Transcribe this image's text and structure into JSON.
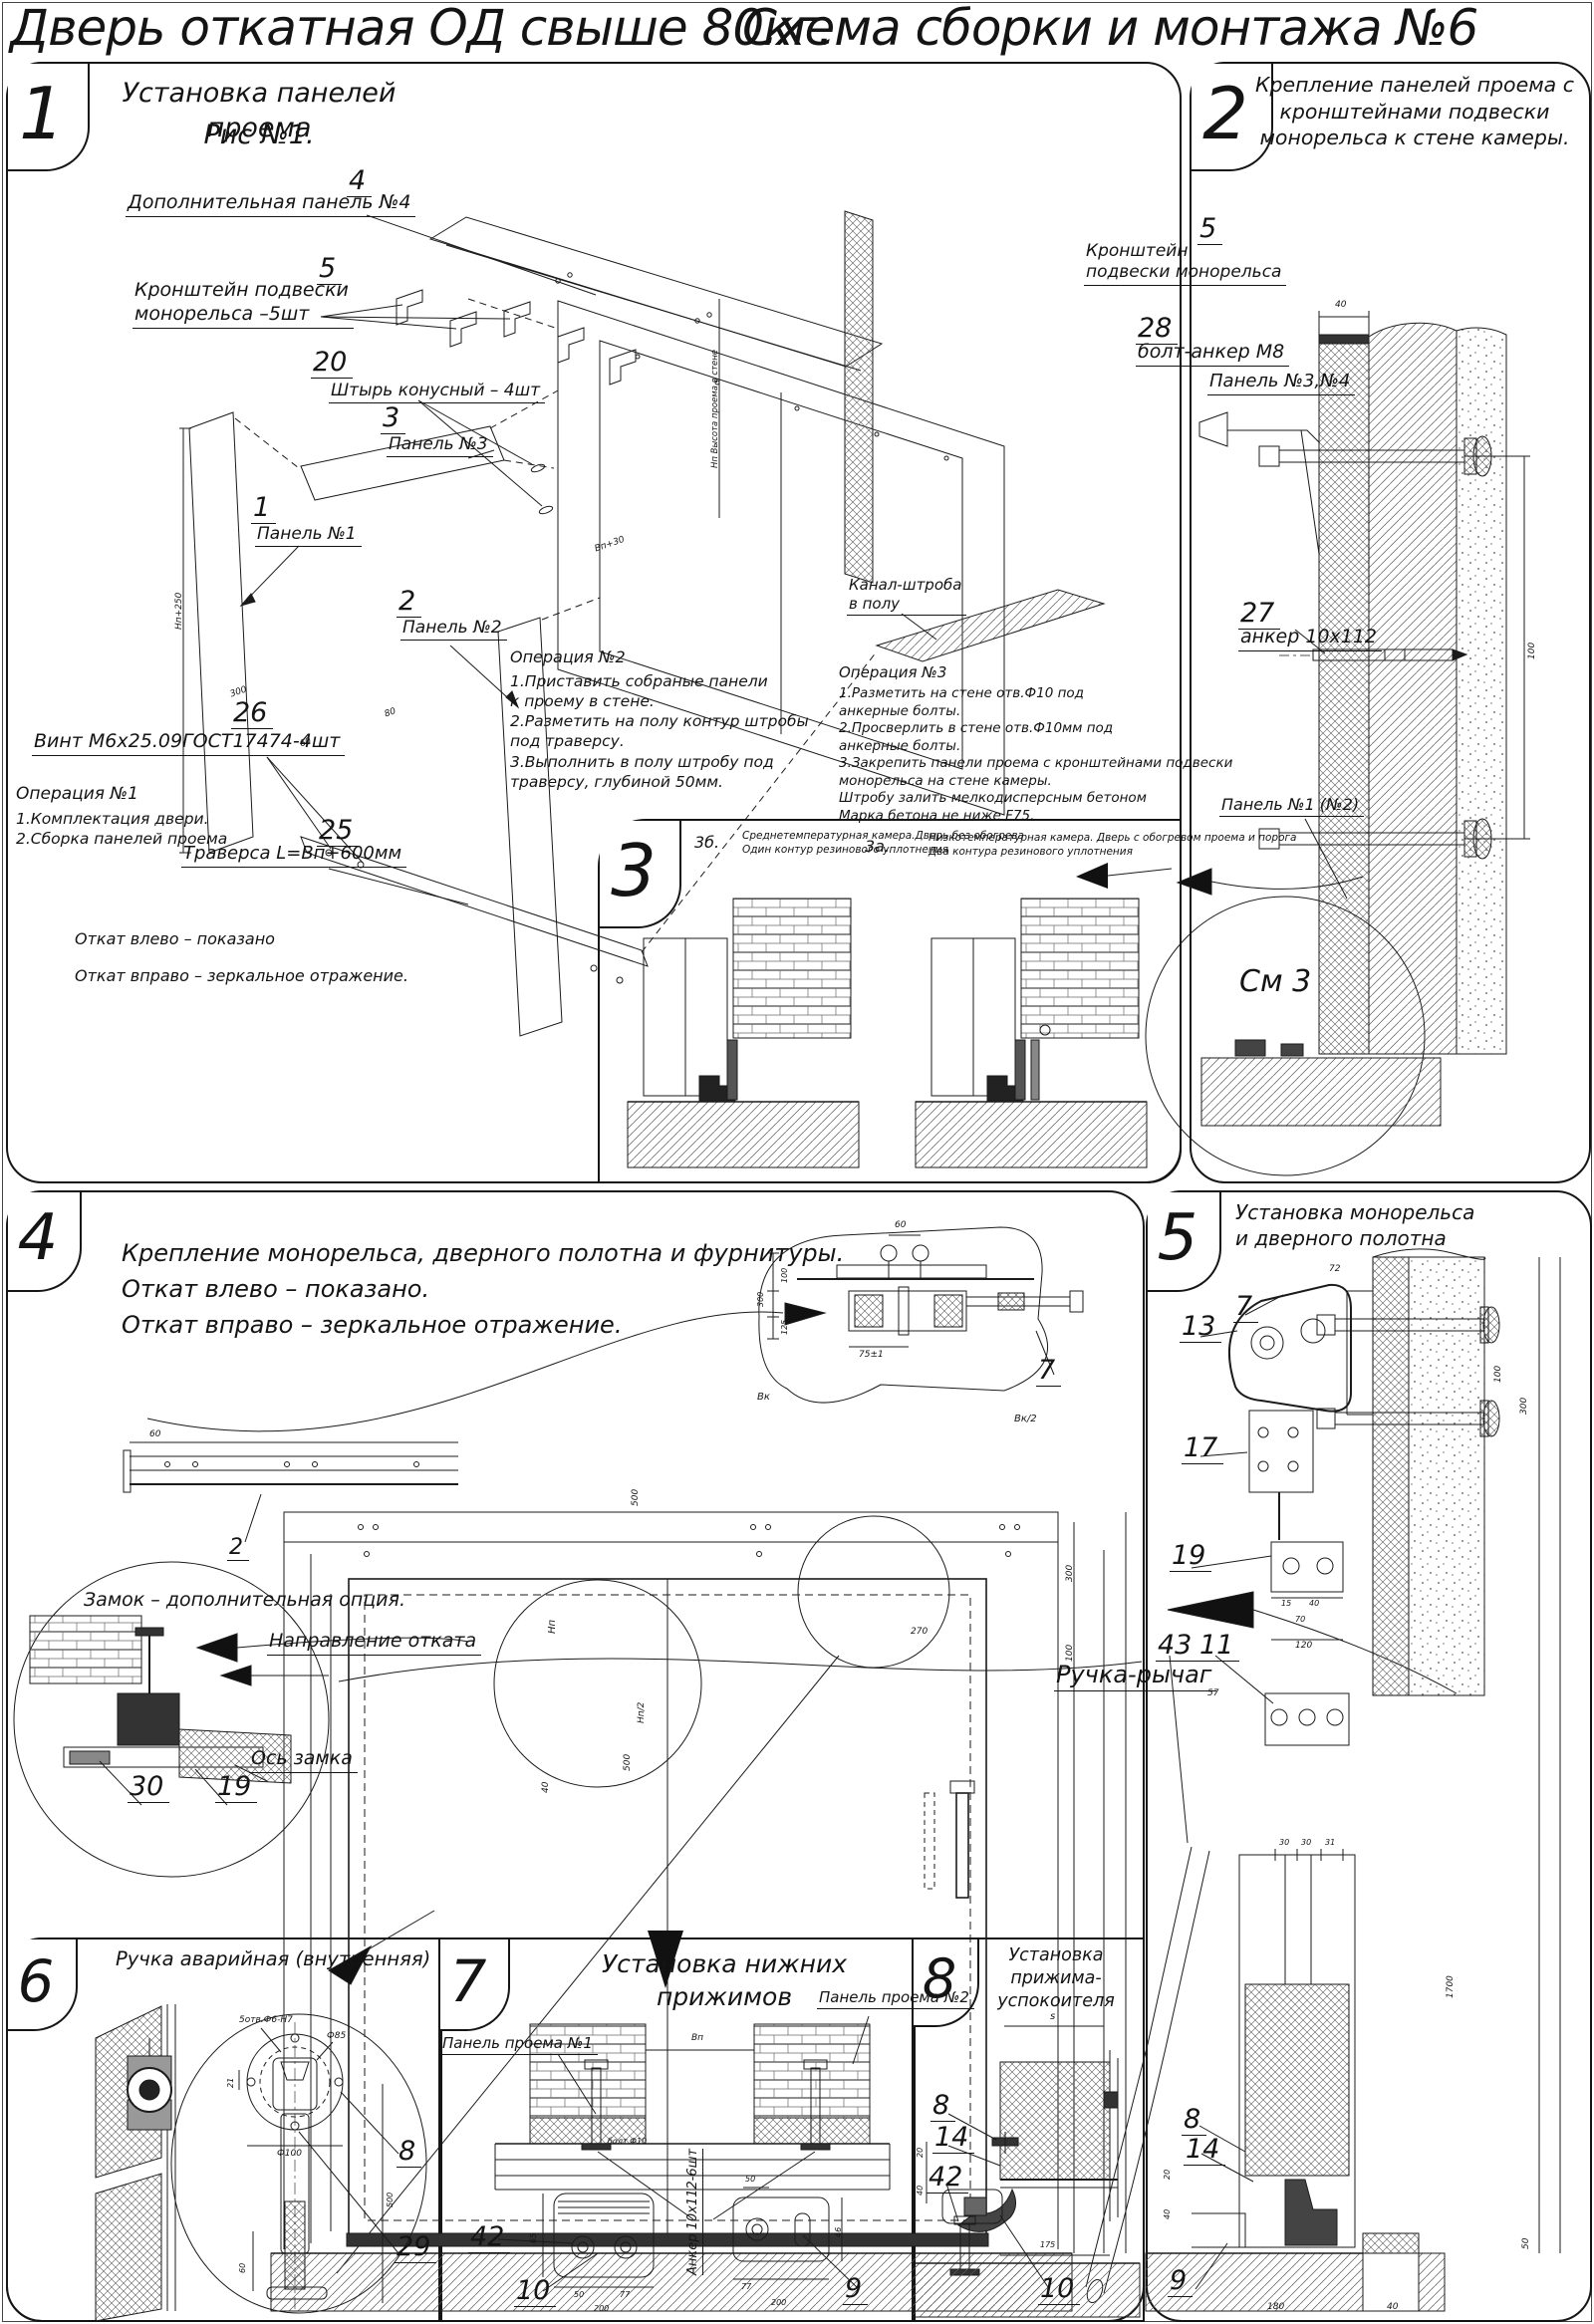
{
  "page": {
    "title_left": "Дверь откатная ОД свыше 80кг.",
    "title_right": "Схема сборки и монтажа №6"
  },
  "s1": {
    "num": "1",
    "title": "Установка панелей проема",
    "subtitle": "Рис №1.",
    "callouts": {
      "c4": {
        "num": "4",
        "label": "Дополнительная панель №4"
      },
      "c5": {
        "num": "5",
        "label": "Кронштейн подвески\nмонорельса –5шт"
      },
      "c20": {
        "num": "20",
        "label": "Штырь конусный – 4шт"
      },
      "c3": {
        "num": "3",
        "label": "Панель №3"
      },
      "c1": {
        "num": "1",
        "label": "Панель №1"
      },
      "c2": {
        "num": "2",
        "label": "Панель №2"
      },
      "c26": {
        "num": "26",
        "label": "Винт М6х25.09ГОСТ17474-4шт"
      },
      "c25": {
        "num": "25",
        "label": "Траверса  L=Вп+600мм"
      },
      "kanal": {
        "label": "Канал-штроба\nв полу"
      }
    },
    "op1_title": "Операция №1",
    "op1_text": "1.Комплектация двери.\n2.Сборка панелей проема",
    "op2_title": "Операция №2",
    "op2_text": "1.Приставить собраные панели\nк проему в стене.\n2.Разметить на полу контур штробы\nпод траверсу.\n3.Выполнить в полу штробу под\nтраверсу, глубиной 50мм.",
    "op3_title": "Операция №3",
    "op3_text": "1.Разметить на стене отв.Ф10 под\nанкерные болты.\n2.Просверлить в стене отв.Ф10мм   под\nанкерные болты.\n3.Закрепить панели проема с кронштейнами подвески\nмонорельса на стене камеры.\nШтробу залить мелкодисперсным бетоном\nМарка бетона не ниже   F75.",
    "note1": "Откат влево – показано",
    "note2": "Откат вправо – зеркальное отражение.",
    "dims": {
      "hp": "Нп+250",
      "bp30": "Вп+30",
      "d300": "300",
      "d80": "80",
      "d60": "60",
      "hp_note": "Нп Высота проема в стене"
    }
  },
  "s2": {
    "num": "2",
    "title": "Крепление панелей проема с\nкронштейнами  подвески\nмонорельса к стене камеры.",
    "callouts": {
      "c5": {
        "num": "5",
        "label": "Кронштейн\nподвески монорельса"
      },
      "c28": {
        "num": "28",
        "label": "болт-анкер М8"
      },
      "p34": {
        "label": "Панель №3,№4"
      },
      "c27": {
        "num": "27",
        "label": "анкер 10х112"
      },
      "p12": {
        "label": "Панель №1 (№2)"
      },
      "sm3": {
        "label": "См 3"
      }
    },
    "dims": {
      "d40": "40",
      "d100": "100"
    }
  },
  "s3": {
    "num": "3",
    "b_key": "3б.",
    "b_text": "Среднетемпературная камера.Дверь без обогрева\nОдин контур резинового уплотнения",
    "a_key": "3а.",
    "a_text": "Низкотемпературная камера. Дверь с обогревом проема и порога\nДва контура резинового уплотнения"
  },
  "s4": {
    "num": "4",
    "title": "Крепление монорельса, дверного полотна и фурнитуры.\nОткат влево – показано.\nОткат вправо – зеркальное отражение.",
    "callouts": {
      "c7": {
        "num": "7"
      },
      "c2": {
        "num": "2"
      },
      "c30": {
        "num": "30"
      },
      "c19": {
        "num": "19"
      },
      "zamok": {
        "label": "Замок – дополнительная опция."
      },
      "napr": {
        "label": "Направление отката"
      },
      "os": {
        "label": "Ось замка"
      }
    },
    "dims": {
      "d60": "60",
      "d60m": "60",
      "d75": "75±1",
      "d300": "300",
      "d100": "100",
      "d125": "125",
      "bk": "Вк",
      "bk2": "Вк/2",
      "d500": "500",
      "np": "Нп",
      "np2": "Нп/2",
      "d500b": "500",
      "d40": "40",
      "d270": "270",
      "d300b": "300",
      "d100b": "100"
    }
  },
  "s5": {
    "num": "5",
    "title": "Установка монорельса\nи дверного полотна",
    "callouts": {
      "c7": {
        "num": "7"
      },
      "c13": {
        "num": "13"
      },
      "c17": {
        "num": "17"
      },
      "c19": {
        "num": "19"
      },
      "c43": {
        "num": "43"
      },
      "c11": {
        "num": "11"
      },
      "ruchka": {
        "label": "Ручка-рычаг"
      },
      "c8": {
        "num": "8"
      },
      "c14": {
        "num": "14"
      },
      "c9": {
        "num": "9"
      }
    },
    "dims": {
      "d72": "72",
      "d100": "100",
      "d300": "300",
      "d1700": "1700",
      "d30a": "30",
      "d30b": "30",
      "d31": "31",
      "d15": "15",
      "d40a": "40",
      "d70": "70",
      "d120": "120",
      "d57": "57",
      "d20": "20",
      "d40b": "40",
      "d180": "180",
      "d40c": "40",
      "d50": "50"
    }
  },
  "s6": {
    "num": "6",
    "title": "Ручка аварийная (внутренняя)",
    "callouts": {
      "c8": {
        "num": "8"
      },
      "c29": {
        "num": "29"
      }
    },
    "dims": {
      "otv": "5отв.Ф6-Н7",
      "f85": "Ф85",
      "f100": "Ф100",
      "d21": "21",
      "d500": "500",
      "d60": "60"
    }
  },
  "s7": {
    "num": "7",
    "title": "Установка нижних прижимов",
    "callouts": {
      "p1": {
        "label": "Панель проема №1"
      },
      "p2": {
        "label": "Панель проема №2"
      },
      "c42": {
        "num": "42"
      },
      "c10": {
        "num": "10"
      },
      "c9": {
        "num": "9"
      }
    },
    "anchor_note": "Анкер  10х112-6шт",
    "dims": {
      "bp": "Вп",
      "bolt": "болт Ф10",
      "d65": "65",
      "d50a": "50",
      "d77a": "77",
      "d200a": "200",
      "d50b": "50",
      "d46": "46",
      "d77b": "77",
      "d200b": "200"
    }
  },
  "s8": {
    "num": "8",
    "title": "Установка\nприжима-успокоителя",
    "callouts": {
      "c8": {
        "num": "8"
      },
      "c14": {
        "num": "14"
      },
      "c42": {
        "num": "42"
      },
      "c10": {
        "num": "10"
      }
    },
    "dims": {
      "s": "s",
      "d20": "20",
      "d40": "40",
      "d175": "175"
    }
  }
}
